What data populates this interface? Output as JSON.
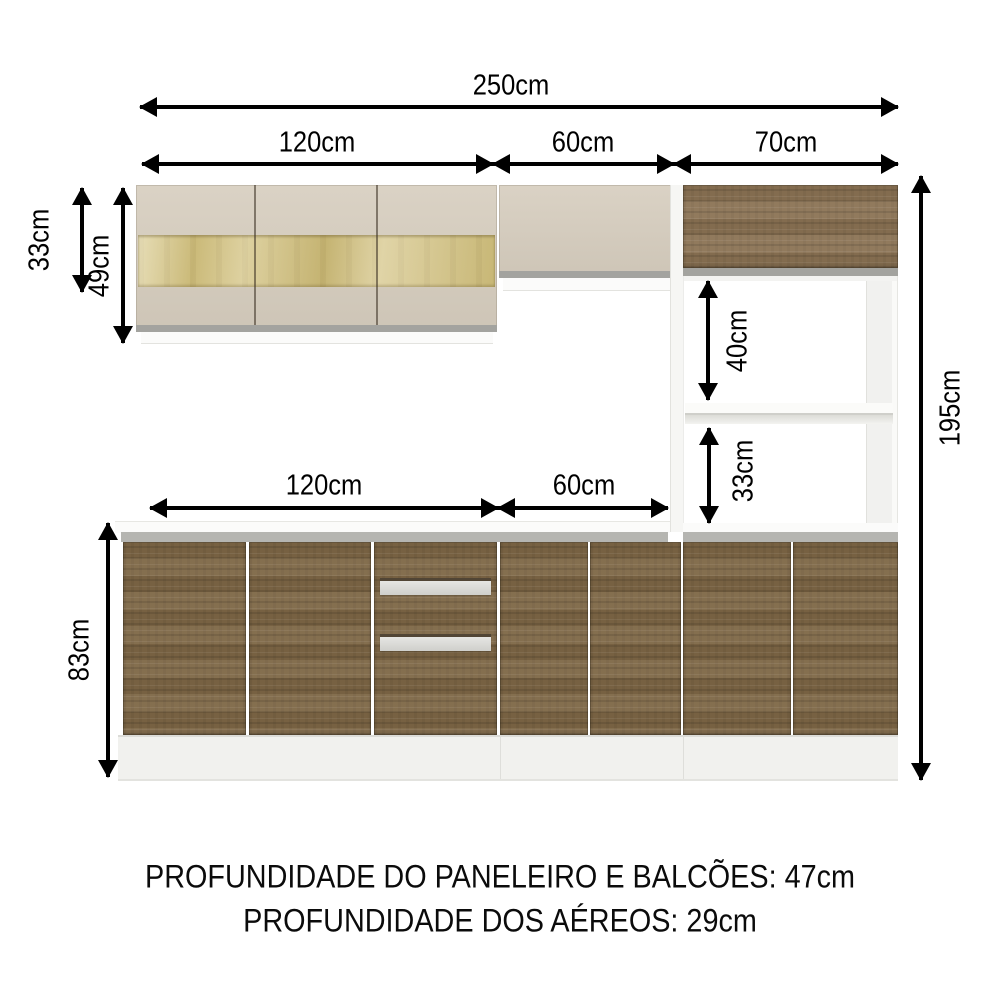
{
  "dimensions": {
    "overall_width": "250cm",
    "upper_row": {
      "left": "120cm",
      "middle": "60cm",
      "right": "70cm"
    },
    "upper_cabinet_heights": {
      "small": "33cm",
      "large": "49cm"
    },
    "tower_openings": {
      "upper": "40cm",
      "lower": "33cm"
    },
    "overall_height": "195cm",
    "base_row": {
      "left": "120cm",
      "middle": "60cm"
    },
    "base_height": "83cm"
  },
  "footer": {
    "line1": "PROFUNDIDADE DO PANELEIRO E BALCÕES: 47cm",
    "line2": "PROFUNDIDADE DOS AÉREOS: 29cm"
  },
  "colors": {
    "wood_base": "#7e6746",
    "wood_upper": "#8b7354",
    "cream": "#d6cdbe",
    "glass": "#c9b878",
    "counter_strip": "#b5b5b1",
    "plinth": "#f1f1ee",
    "arrow": "#000000"
  }
}
